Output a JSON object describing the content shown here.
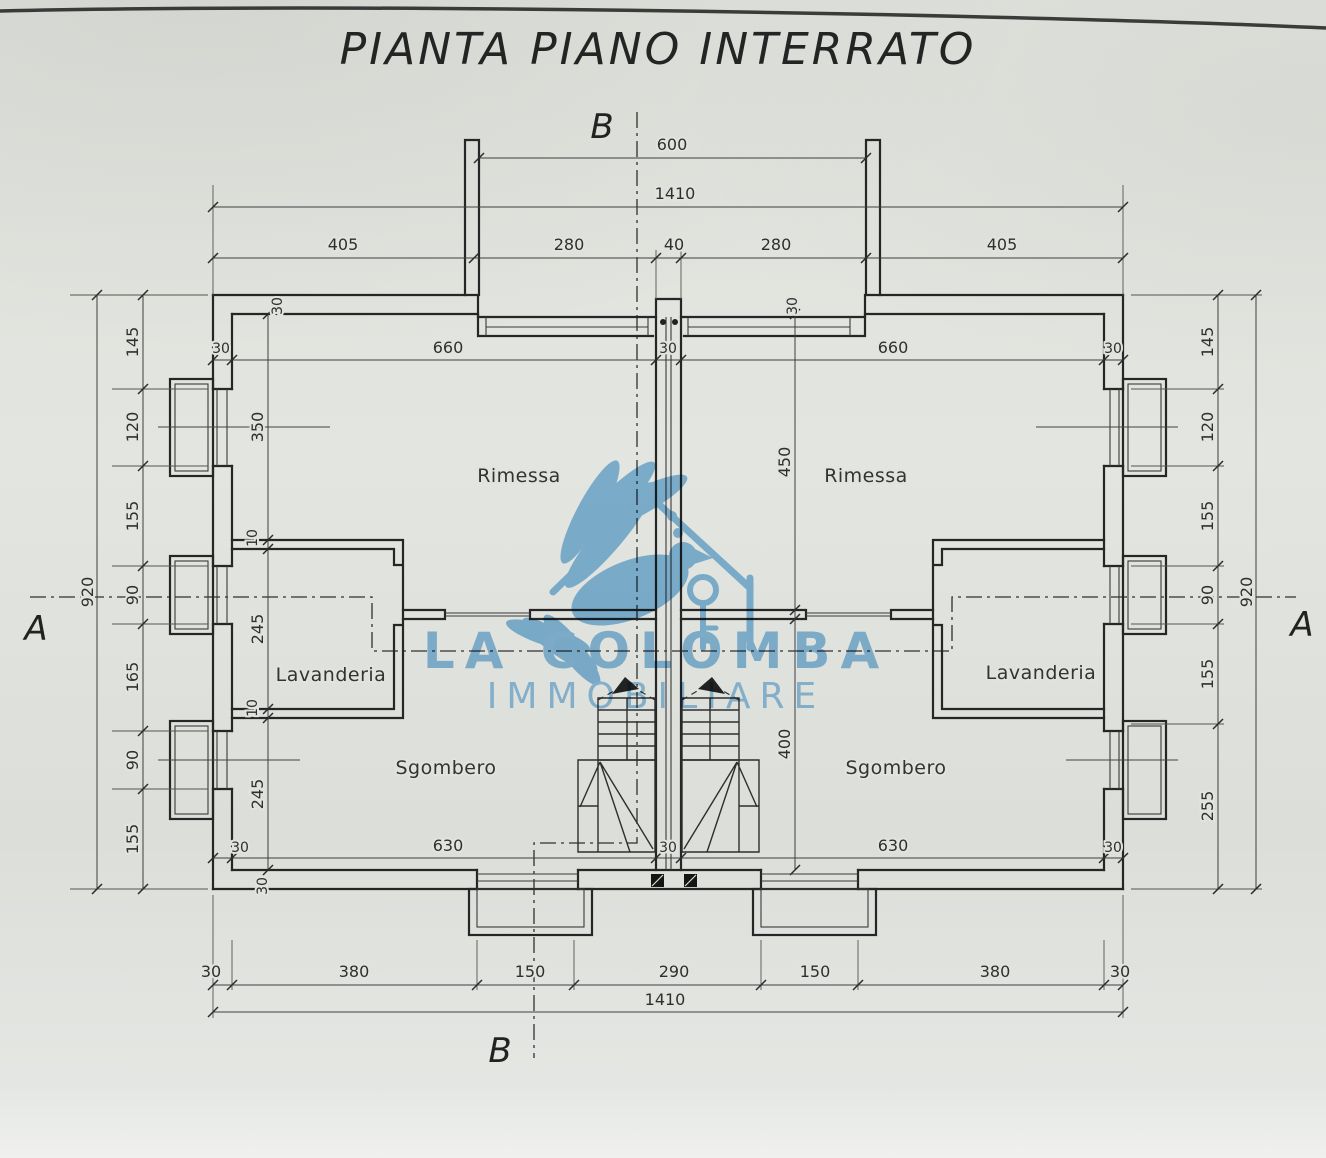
{
  "title": "PIANTA PIANO INTERRATO",
  "markers": {
    "a": "A",
    "b": "B"
  },
  "rooms": {
    "rimessa": "Rimessa",
    "lavanderia": "Lavanderia",
    "sgombero": "Sgombero"
  },
  "watermark": {
    "name": "LA COLOMBA",
    "subtitle": "IMMOBILIARE",
    "logo": "dove-house-key-logo",
    "color": "#6fb1e0"
  },
  "dims": {
    "top_opening": "600",
    "top_total": "1410",
    "top_row": [
      "405",
      "280",
      "40",
      "280",
      "405"
    ],
    "bottom_row": [
      "30",
      "380",
      "150",
      "290",
      "150",
      "380",
      "30"
    ],
    "bottom_total": "1410",
    "left_chain": [
      "145",
      "120",
      "155",
      "90",
      "165",
      "90",
      "155"
    ],
    "left_total": "920",
    "right_chain": [
      "145",
      "120",
      "155",
      "90",
      "155",
      "255"
    ],
    "right_total": "920"
  },
  "int": {
    "w660": "660",
    "w630": "630",
    "d350": "350",
    "d450": "450",
    "d400": "400",
    "d245": "245",
    "t30": "30",
    "t10": "10"
  },
  "colors": {
    "paper": "#e1e3de",
    "line": "#2a2a2a",
    "logo_blue": "#6fb1e0"
  }
}
